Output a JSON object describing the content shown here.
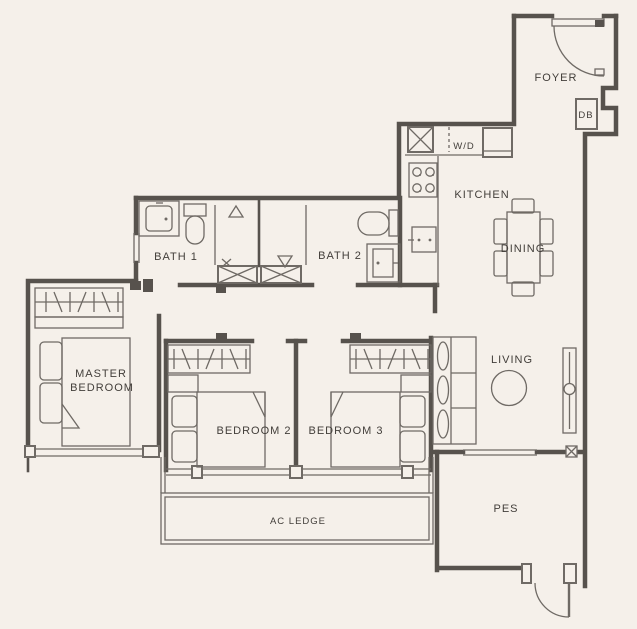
{
  "plan": {
    "type": "residential-floor-plan",
    "rooms": {
      "foyer": "FOYER",
      "kitchen": "KITCHEN",
      "dining": "DINING",
      "bath1": "BATH 1",
      "bath2": "BATH 2",
      "master_line1": "MASTER",
      "master_line2": "BEDROOM",
      "bedroom2": "BEDROOM 2",
      "bedroom3": "BEDROOM 3",
      "living": "LIVING",
      "pes": "PES",
      "ac_ledge": "AC LEDGE"
    },
    "fixtures": {
      "db": "DB",
      "wd": "W/D"
    },
    "colors": {
      "background": "#f5f0ea",
      "wall": "#57524d",
      "thin_line": "#6f6a65",
      "text": "#423e3a"
    }
  }
}
